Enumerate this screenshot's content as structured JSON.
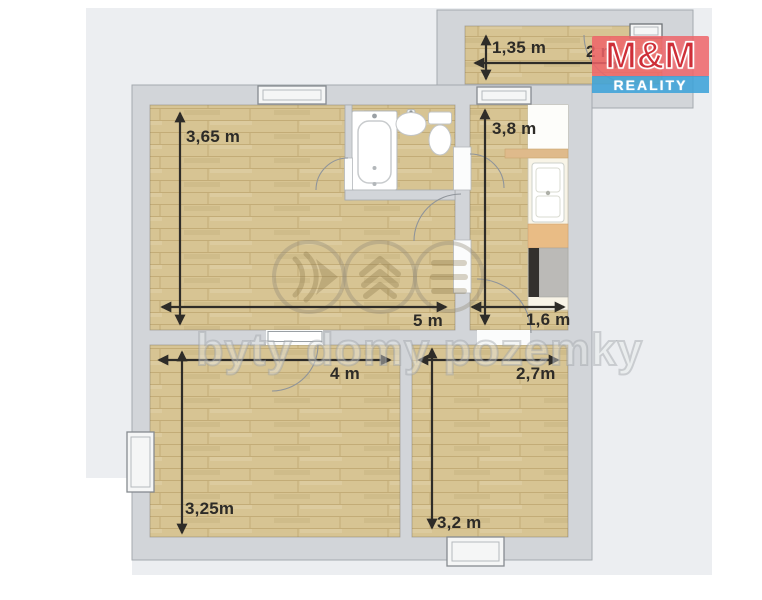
{
  "brand": {
    "name": "M&M",
    "tagline": "REALITY",
    "colors": {
      "red": "#ce2f38",
      "red_bg": "#ee6468",
      "blue_bg": "#3ea3d8",
      "text": "#ffffff"
    }
  },
  "watermark": {
    "text": "byty domy pozemky",
    "icons": [
      "speed-chevrons-icon",
      "house-roof-icon",
      "stacked-lines-icon"
    ]
  },
  "floorplan": {
    "colors": {
      "wall": "#d2d5d9",
      "floor_wood": "#d7c493",
      "outside": "#eceef1",
      "dimension_text": "#2d2b27"
    },
    "rooms": {
      "entry": {
        "label": "entry-porch",
        "width": "2 m",
        "height": "1,35 m"
      },
      "living": {
        "label": "living-room",
        "width": "5 m",
        "height": "3,65 m"
      },
      "kitchen": {
        "label": "kitchen-corridor",
        "width": "1,6 m",
        "height": "3,8 m"
      },
      "bedroom_left": {
        "label": "bedroom-left",
        "width": "4 m",
        "height": "3,25m"
      },
      "bedroom_right": {
        "label": "bedroom-right",
        "width": "2,7m",
        "height": "3,2 m"
      }
    },
    "fixtures": [
      "bathtub",
      "bathroom-sink",
      "toilet",
      "kitchen-counter",
      "kitchen-sink",
      "stove"
    ]
  }
}
